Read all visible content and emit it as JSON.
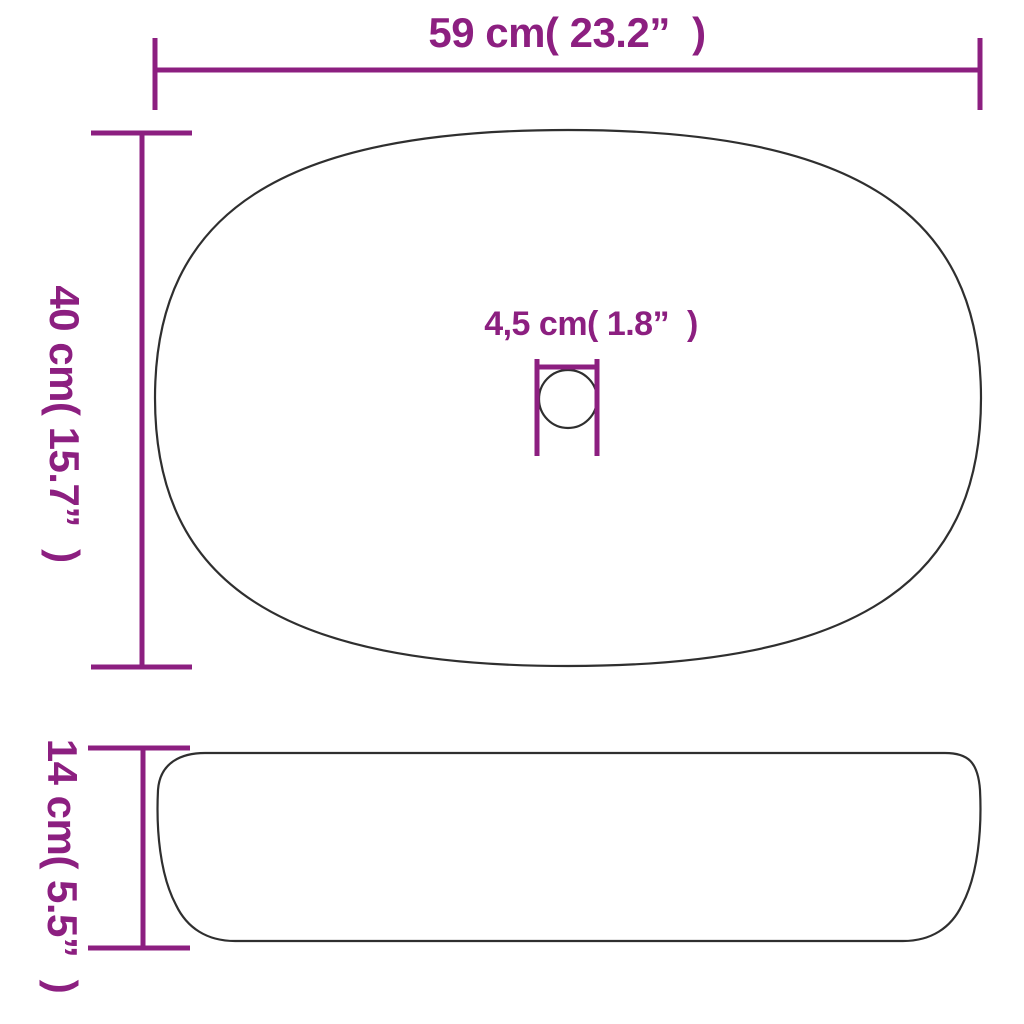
{
  "diagram": {
    "type": "product-dimension-drawing",
    "subject": "oval countertop wash basin, top view and side view",
    "colors": {
      "accent": "#8c1f80",
      "outline": "#2f2f2f",
      "background": "#ffffff"
    },
    "dimensions": {
      "width": {
        "label": "59 cm( 23.2”  )",
        "value_cm": "59",
        "value_in": "23.2"
      },
      "depth": {
        "label": "40 cm( 15.7”  )",
        "value_cm": "40",
        "value_in": "15.7"
      },
      "drain": {
        "label": "4,5 cm( 1.8”  )",
        "value_cm": "4,5",
        "value_in": "1.8"
      },
      "height": {
        "label": "14 cm( 5.5”  )",
        "value_cm": "14",
        "value_in": "5.5"
      }
    }
  }
}
